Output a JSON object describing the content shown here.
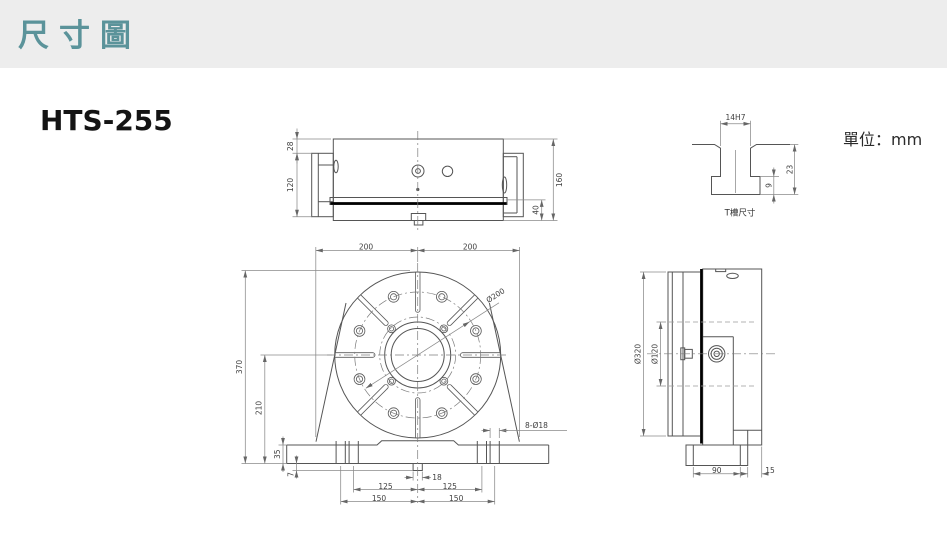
{
  "header": {
    "title": "尺寸圖"
  },
  "content": {
    "model": "HTS-255",
    "unit_label": "單位：mm"
  },
  "top_view": {
    "dims": {
      "h28": "28",
      "h120": "120",
      "h160": "160",
      "h40": "40"
    }
  },
  "front_view": {
    "dims": {
      "w200_left": "200",
      "w200_right": "200",
      "h370": "370",
      "h210": "210",
      "h35": "35",
      "h7": "7",
      "w18": "18",
      "w125_left": "125",
      "w125_right": "125",
      "w150_left": "150",
      "w150_right": "150",
      "dia200": "Ø200",
      "holes_callout": "8-Ø18"
    }
  },
  "side_view": {
    "dims": {
      "dia320": "Ø320",
      "dia120": "Ø120",
      "w90": "90",
      "w15": "15"
    }
  },
  "tslot_view": {
    "label": "T槽尺寸",
    "dims": {
      "w14h7": "14H7",
      "h23": "23",
      "h9": "9"
    }
  }
}
